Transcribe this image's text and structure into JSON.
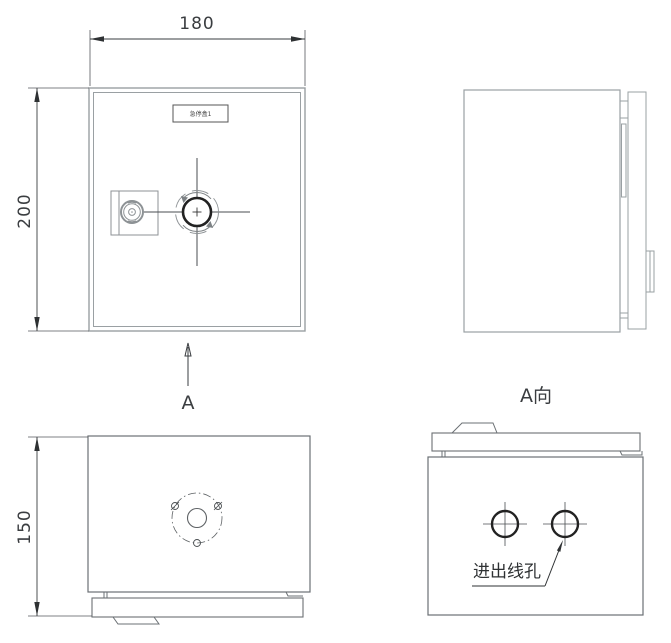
{
  "drawing": {
    "dimensions": {
      "front_width": "180",
      "front_height": "200",
      "side_depth": "150"
    },
    "view_labels": {
      "arrow_letter": "A",
      "direction_view": "A向"
    },
    "nameplate": "急停盒1",
    "annotations": {
      "wire_holes": "进出线孔"
    },
    "colors": {
      "line_light": "#9aa0a3",
      "line_mid": "#6b7074",
      "line_dark": "#2e3133"
    }
  }
}
